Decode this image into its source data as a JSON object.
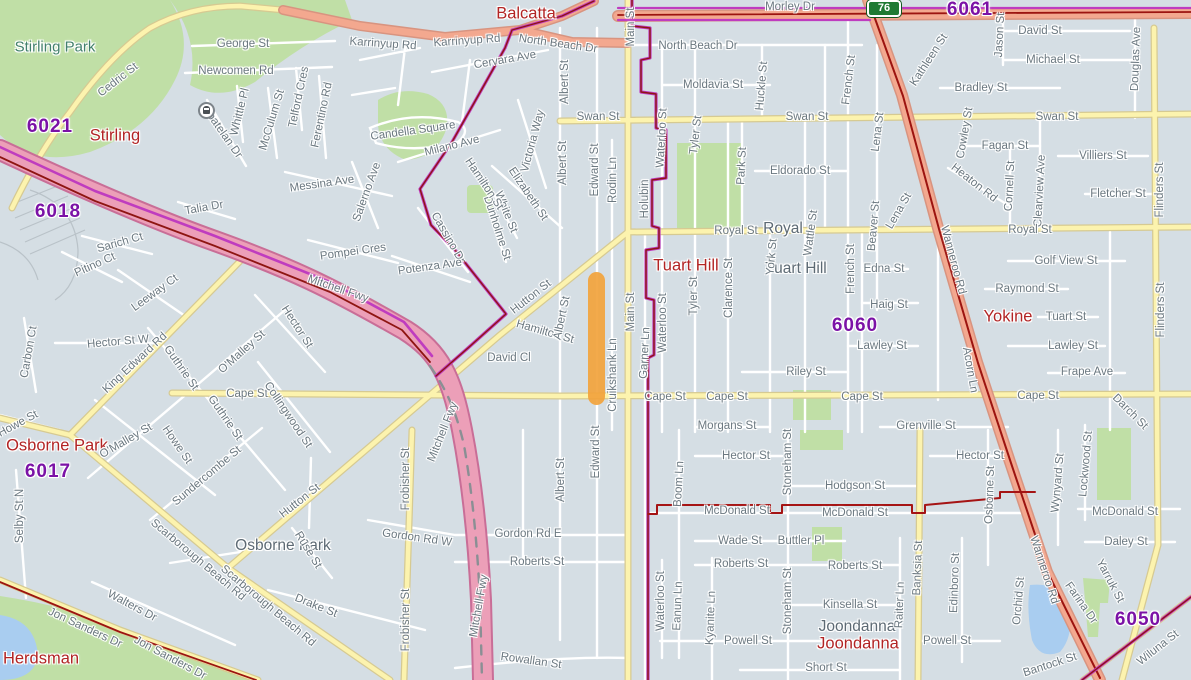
{
  "map": {
    "width": 1191,
    "height": 680,
    "description": "Street map of Perth suburbs: Stirling, Balcatta, Tuart Hill, Yokine, Osborne Park, Joondanna, Herdsman"
  },
  "colors": {
    "background": "#d5dee4",
    "park_green": "#c0dfa6",
    "water_blue": "#a9cdf0",
    "local_road": "#ffffff",
    "major_road_yellow": "#fcf3ae",
    "highway_salmon": "#f3a88f",
    "freeway_pink": "#ec9fb8",
    "boundary_magenta": "#bf3cbf",
    "boundary_dark_red": "#8e1512",
    "highlight_orange": "#F2A33C",
    "street_label": "#6b7880",
    "suburb_label_red": "#b22424",
    "postcode_purple": "#7b12a6",
    "shield_green": "#1f7a33"
  },
  "shield": {
    "label": "76"
  },
  "highlight": {
    "street": "Edward St",
    "color": "#F2A33C"
  },
  "labels": {
    "parks": [
      {
        "t": "Stirling Park",
        "x": 55,
        "y": 47
      }
    ],
    "suburbs": [
      {
        "t": "Balcatta",
        "x": 526,
        "y": 14
      },
      {
        "t": "Stirling",
        "x": 115,
        "y": 136
      },
      {
        "t": "Tuart Hill",
        "x": 686,
        "y": 266
      },
      {
        "t": "Yokine",
        "x": 1008,
        "y": 317
      },
      {
        "t": "Osborne Park",
        "x": 57,
        "y": 446
      },
      {
        "t": "Joondanna",
        "x": 858,
        "y": 644
      },
      {
        "t": "Herdsman",
        "x": 41,
        "y": 659
      }
    ],
    "localities": [
      {
        "t": "Royal",
        "x": 783,
        "y": 229
      },
      {
        "t": "Tuart Hill",
        "x": 796,
        "y": 269
      },
      {
        "t": "Osborne Park",
        "x": 283,
        "y": 546
      },
      {
        "t": "Joondanna",
        "x": 857,
        "y": 627
      }
    ],
    "postcodes": [
      {
        "t": "6021",
        "x": 50,
        "y": 127
      },
      {
        "t": "6018",
        "x": 58,
        "y": 212
      },
      {
        "t": "6061",
        "x": 970,
        "y": 10
      },
      {
        "t": "6060",
        "x": 855,
        "y": 326
      },
      {
        "t": "6017",
        "x": 48,
        "y": 472
      },
      {
        "t": "6050",
        "x": 1138,
        "y": 620
      }
    ],
    "streets": [
      {
        "t": "George St",
        "x": 243,
        "y": 44
      },
      {
        "t": "Newcomen Rd",
        "x": 236,
        "y": 71
      },
      {
        "t": "Cedric St",
        "x": 118,
        "y": 80,
        "r": -38
      },
      {
        "t": "Whittle Pl",
        "x": 240,
        "y": 112,
        "r": -76
      },
      {
        "t": "McCulum St",
        "x": 272,
        "y": 120,
        "r": -73
      },
      {
        "t": "Coatelan Dr",
        "x": 222,
        "y": 132,
        "r": 55
      },
      {
        "t": "Telford Cres",
        "x": 299,
        "y": 97,
        "r": -78
      },
      {
        "t": "Ferentino Rd",
        "x": 322,
        "y": 115,
        "r": -78
      },
      {
        "t": "Candella Square",
        "x": 413,
        "y": 131,
        "r": -8
      },
      {
        "t": "Milano Ave",
        "x": 452,
        "y": 146,
        "r": -14
      },
      {
        "t": "Cervara Ave",
        "x": 505,
        "y": 60,
        "r": -10
      },
      {
        "t": "Salerno Ave",
        "x": 367,
        "y": 192,
        "r": -70
      },
      {
        "t": "Messina Ave",
        "x": 322,
        "y": 184,
        "r": -8
      },
      {
        "t": "Victoria Way",
        "x": 533,
        "y": 141,
        "r": -75
      },
      {
        "t": "Elizabeth St",
        "x": 528,
        "y": 194,
        "r": 56
      },
      {
        "t": "White St",
        "x": 506,
        "y": 212,
        "r": 68
      },
      {
        "t": "Dunholme St",
        "x": 497,
        "y": 228,
        "r": 72
      },
      {
        "t": "Cassino Dr",
        "x": 448,
        "y": 238,
        "r": 60
      },
      {
        "t": "Pompei Cres",
        "x": 353,
        "y": 252,
        "r": -8
      },
      {
        "t": "Potenza Ave",
        "x": 430,
        "y": 267,
        "r": -8
      },
      {
        "t": "Hamilton St",
        "x": 484,
        "y": 184,
        "r": 56
      },
      {
        "t": "Hamilton St",
        "x": 545,
        "y": 332,
        "r": 16
      },
      {
        "t": "Hutton St",
        "x": 531,
        "y": 297,
        "r": -38
      },
      {
        "t": "Hutton St",
        "x": 300,
        "y": 501,
        "r": -38
      },
      {
        "t": "Karrinyup Rd",
        "x": 383,
        "y": 44,
        "r": 4
      },
      {
        "t": "Karrinyup Rd",
        "x": 467,
        "y": 41,
        "r": -4
      },
      {
        "t": "North Beach Dr",
        "x": 558,
        "y": 44,
        "r": 8
      },
      {
        "t": "North Beach Dr",
        "x": 698,
        "y": 46
      },
      {
        "t": "Albert St",
        "x": 565,
        "y": 82,
        "r": -90
      },
      {
        "t": "Albert St",
        "x": 563,
        "y": 163,
        "r": -90
      },
      {
        "t": "Albert St",
        "x": 562,
        "y": 318,
        "r": -78
      },
      {
        "t": "Albert St",
        "x": 561,
        "y": 480,
        "r": -90
      },
      {
        "t": "Edward St",
        "x": 595,
        "y": 170,
        "r": -90
      },
      {
        "t": "Edward St",
        "x": 596,
        "y": 452,
        "r": -90
      },
      {
        "t": "Rodin Ln",
        "x": 613,
        "y": 180,
        "r": -90
      },
      {
        "t": "Main St",
        "x": 631,
        "y": 27,
        "r": -90
      },
      {
        "t": "Main St",
        "x": 631,
        "y": 312,
        "r": -90
      },
      {
        "t": "Holubin",
        "x": 645,
        "y": 199,
        "r": -90
      },
      {
        "t": "Garner Ln",
        "x": 645,
        "y": 353,
        "r": -87
      },
      {
        "t": "Cruikshank Ln",
        "x": 613,
        "y": 375,
        "r": -90
      },
      {
        "t": "Swan St",
        "x": 598,
        "y": 117
      },
      {
        "t": "Swan St",
        "x": 807,
        "y": 117
      },
      {
        "t": "Swan St",
        "x": 1057,
        "y": 117
      },
      {
        "t": "Moldavia St",
        "x": 713,
        "y": 85
      },
      {
        "t": "Huckle St",
        "x": 762,
        "y": 86,
        "r": -85
      },
      {
        "t": "Waterloo St",
        "x": 662,
        "y": 138,
        "r": -87
      },
      {
        "t": "Waterloo St",
        "x": 663,
        "y": 323,
        "r": -90
      },
      {
        "t": "Waterloo St",
        "x": 661,
        "y": 601,
        "r": -90
      },
      {
        "t": "Tyler St",
        "x": 696,
        "y": 135,
        "r": -83
      },
      {
        "t": "Tyler St",
        "x": 694,
        "y": 296,
        "r": -90
      },
      {
        "t": "Park St",
        "x": 742,
        "y": 166,
        "r": -87
      },
      {
        "t": "Eldorado St",
        "x": 800,
        "y": 171
      },
      {
        "t": "French St",
        "x": 849,
        "y": 80,
        "r": -83
      },
      {
        "t": "French St",
        "x": 851,
        "y": 269,
        "r": -90
      },
      {
        "t": "Lena St",
        "x": 878,
        "y": 132,
        "r": -83
      },
      {
        "t": "Lena St",
        "x": 899,
        "y": 211,
        "r": -60
      },
      {
        "t": "Kathleen St",
        "x": 929,
        "y": 60,
        "r": -57
      },
      {
        "t": "Jason St",
        "x": 1000,
        "y": 35,
        "r": -87
      },
      {
        "t": "David St",
        "x": 1040,
        "y": 31
      },
      {
        "t": "Michael St",
        "x": 1053,
        "y": 60
      },
      {
        "t": "Bradley St",
        "x": 981,
        "y": 88
      },
      {
        "t": "Douglas Ave",
        "x": 1136,
        "y": 59,
        "r": -88
      },
      {
        "t": "Cowley St",
        "x": 965,
        "y": 133,
        "r": -80
      },
      {
        "t": "Fagan St",
        "x": 1005,
        "y": 146
      },
      {
        "t": "Villiers St",
        "x": 1103,
        "y": 156
      },
      {
        "t": "Cornell St",
        "x": 1010,
        "y": 186,
        "r": -87
      },
      {
        "t": "Clearview Ave",
        "x": 1040,
        "y": 191,
        "r": -87
      },
      {
        "t": "Heaton Rd",
        "x": 974,
        "y": 183,
        "r": 38
      },
      {
        "t": "Fletcher St",
        "x": 1118,
        "y": 194
      },
      {
        "t": "Flinders St",
        "x": 1160,
        "y": 190,
        "r": -90
      },
      {
        "t": "Flinders St",
        "x": 1161,
        "y": 310,
        "r": -90
      },
      {
        "t": "Royal St",
        "x": 736,
        "y": 231
      },
      {
        "t": "Royal St",
        "x": 1030,
        "y": 230
      },
      {
        "t": "Edna St",
        "x": 884,
        "y": 269
      },
      {
        "t": "Haig St",
        "x": 889,
        "y": 305
      },
      {
        "t": "Beaver St",
        "x": 874,
        "y": 226,
        "r": -85
      },
      {
        "t": "Wattle St",
        "x": 811,
        "y": 233,
        "r": -82
      },
      {
        "t": "York St",
        "x": 772,
        "y": 257,
        "r": -85
      },
      {
        "t": "Clarence St",
        "x": 729,
        "y": 288,
        "r": -90
      },
      {
        "t": "Lawley St",
        "x": 882,
        "y": 346
      },
      {
        "t": "Lawley St",
        "x": 1073,
        "y": 346
      },
      {
        "t": "Riley St",
        "x": 806,
        "y": 372
      },
      {
        "t": "Golf View St",
        "x": 1066,
        "y": 261
      },
      {
        "t": "Raymond St",
        "x": 1027,
        "y": 289
      },
      {
        "t": "Tuart St",
        "x": 1066,
        "y": 317
      },
      {
        "t": "Frape Ave",
        "x": 1087,
        "y": 372
      },
      {
        "t": "Wanneroo Rd",
        "x": 953,
        "y": 260,
        "r": 75
      },
      {
        "t": "Wanneroo Rd",
        "x": 1044,
        "y": 570,
        "r": 72
      },
      {
        "t": "Acorn Ln",
        "x": 970,
        "y": 370,
        "r": 80
      },
      {
        "t": "Cape St",
        "x": 247,
        "y": 394
      },
      {
        "t": "Cape St",
        "x": 665,
        "y": 397
      },
      {
        "t": "Cape St",
        "x": 727,
        "y": 397
      },
      {
        "t": "Cape St",
        "x": 862,
        "y": 397
      },
      {
        "t": "Cape St",
        "x": 1038,
        "y": 396
      },
      {
        "t": "David Cl",
        "x": 509,
        "y": 358
      },
      {
        "t": "Morgans St",
        "x": 727,
        "y": 426
      },
      {
        "t": "Grenville St",
        "x": 926,
        "y": 426
      },
      {
        "t": "Darch St",
        "x": 1130,
        "y": 412,
        "r": 45
      },
      {
        "t": "Hector St",
        "x": 746,
        "y": 456
      },
      {
        "t": "Hector St",
        "x": 980,
        "y": 456
      },
      {
        "t": "Hector St W",
        "x": 118,
        "y": 342,
        "r": -5
      },
      {
        "t": "Hector St",
        "x": 297,
        "y": 327,
        "r": 57
      },
      {
        "t": "Hodgson St",
        "x": 855,
        "y": 486
      },
      {
        "t": "Stoneham St",
        "x": 788,
        "y": 462,
        "r": -90
      },
      {
        "t": "Stoneham St",
        "x": 788,
        "y": 601,
        "r": -90
      },
      {
        "t": "McDonald St",
        "x": 737,
        "y": 511
      },
      {
        "t": "McDonald St",
        "x": 855,
        "y": 513
      },
      {
        "t": "McDonald St",
        "x": 1125,
        "y": 512
      },
      {
        "t": "Boom Ln",
        "x": 679,
        "y": 484,
        "r": -87
      },
      {
        "t": "Wade St",
        "x": 740,
        "y": 541
      },
      {
        "t": "Buttler Pl",
        "x": 801,
        "y": 541
      },
      {
        "t": "Daley St",
        "x": 1126,
        "y": 542
      },
      {
        "t": "Roberts St",
        "x": 741,
        "y": 564
      },
      {
        "t": "Roberts St",
        "x": 855,
        "y": 566
      },
      {
        "t": "Roberts St",
        "x": 537,
        "y": 562
      },
      {
        "t": "Wynyard St",
        "x": 1058,
        "y": 483,
        "r": -85
      },
      {
        "t": "Lockwood St",
        "x": 1086,
        "y": 464,
        "r": -85
      },
      {
        "t": "Osborne St",
        "x": 990,
        "y": 495,
        "r": -88
      },
      {
        "t": "Kinsella St",
        "x": 850,
        "y": 605
      },
      {
        "t": "Raiter Ln",
        "x": 900,
        "y": 605,
        "r": -88
      },
      {
        "t": "Banksia St",
        "x": 918,
        "y": 568,
        "r": -88
      },
      {
        "t": "Edinboro St",
        "x": 955,
        "y": 583,
        "r": -88
      },
      {
        "t": "Eanun Ln",
        "x": 678,
        "y": 606,
        "r": -88
      },
      {
        "t": "Kyanite Ln",
        "x": 711,
        "y": 618,
        "r": -88
      },
      {
        "t": "Powell St",
        "x": 748,
        "y": 641
      },
      {
        "t": "Powell St",
        "x": 947,
        "y": 641
      },
      {
        "t": "Short St",
        "x": 826,
        "y": 668
      },
      {
        "t": "Orchid St",
        "x": 1019,
        "y": 601,
        "r": -85
      },
      {
        "t": "Yarruk St",
        "x": 1110,
        "y": 581,
        "r": 62
      },
      {
        "t": "Farina Dr",
        "x": 1081,
        "y": 603,
        "r": 55
      },
      {
        "t": "Wiluna St",
        "x": 1158,
        "y": 648,
        "r": -38
      },
      {
        "t": "Bantock St",
        "x": 1050,
        "y": 665,
        "r": -18
      },
      {
        "t": "Morley Dr",
        "x": 790,
        "y": 7
      },
      {
        "t": "Talia Dr",
        "x": 204,
        "y": 208,
        "r": -10
      },
      {
        "t": "Sarich Ct",
        "x": 120,
        "y": 243,
        "r": -16
      },
      {
        "t": "Pitino Ct",
        "x": 95,
        "y": 265,
        "r": -24
      },
      {
        "t": "Leeway Ct",
        "x": 155,
        "y": 293,
        "r": -36
      },
      {
        "t": "Carbon Ct",
        "x": 29,
        "y": 352,
        "r": -80
      },
      {
        "t": "King Edward Rd",
        "x": 135,
        "y": 363,
        "r": -43
      },
      {
        "t": "Guthrie St",
        "x": 181,
        "y": 368,
        "r": 55
      },
      {
        "t": "Guthrie St",
        "x": 225,
        "y": 418,
        "r": 55
      },
      {
        "t": "O'Malley St",
        "x": 242,
        "y": 352,
        "r": -42
      },
      {
        "t": "O'Malley St",
        "x": 126,
        "y": 441,
        "r": -30
      },
      {
        "t": "Collingwood St",
        "x": 288,
        "y": 415,
        "r": 56
      },
      {
        "t": "Howe St",
        "x": 177,
        "y": 445,
        "r": 55
      },
      {
        "t": "Howe St",
        "x": 18,
        "y": 424,
        "r": -28
      },
      {
        "t": "Sundercombe St",
        "x": 207,
        "y": 476,
        "r": -40
      },
      {
        "t": "Selby St N",
        "x": 20,
        "y": 516,
        "r": -90
      },
      {
        "t": "Scarborough Beach Rd",
        "x": 198,
        "y": 560,
        "r": 40
      },
      {
        "t": "Scarborough Beach Rd",
        "x": 268,
        "y": 606,
        "r": 40
      },
      {
        "t": "Walters Dr",
        "x": 132,
        "y": 606,
        "r": 28
      },
      {
        "t": "Jon Sanders Dr",
        "x": 85,
        "y": 628,
        "r": 25
      },
      {
        "t": "Jon Sanders Dr",
        "x": 170,
        "y": 658,
        "r": 28
      },
      {
        "t": "Ruse St",
        "x": 308,
        "y": 550,
        "r": 58
      },
      {
        "t": "Drake St",
        "x": 316,
        "y": 606,
        "r": 22
      },
      {
        "t": "Gordon Rd W",
        "x": 417,
        "y": 538,
        "r": 8
      },
      {
        "t": "Gordon Rd E",
        "x": 528,
        "y": 534
      },
      {
        "t": "Rowallan St",
        "x": 531,
        "y": 661,
        "r": 8
      },
      {
        "t": "Frobisher St",
        "x": 406,
        "y": 479,
        "r": -90
      },
      {
        "t": "Frobisher St",
        "x": 406,
        "y": 620,
        "r": -90
      },
      {
        "t": "Mitchell Fwy",
        "x": 338,
        "y": 289,
        "r": 19
      },
      {
        "t": "Mitchell Fwy",
        "x": 443,
        "y": 432,
        "r": -68
      },
      {
        "t": "Mitchell Fwy",
        "x": 479,
        "y": 606,
        "r": -80
      }
    ]
  }
}
